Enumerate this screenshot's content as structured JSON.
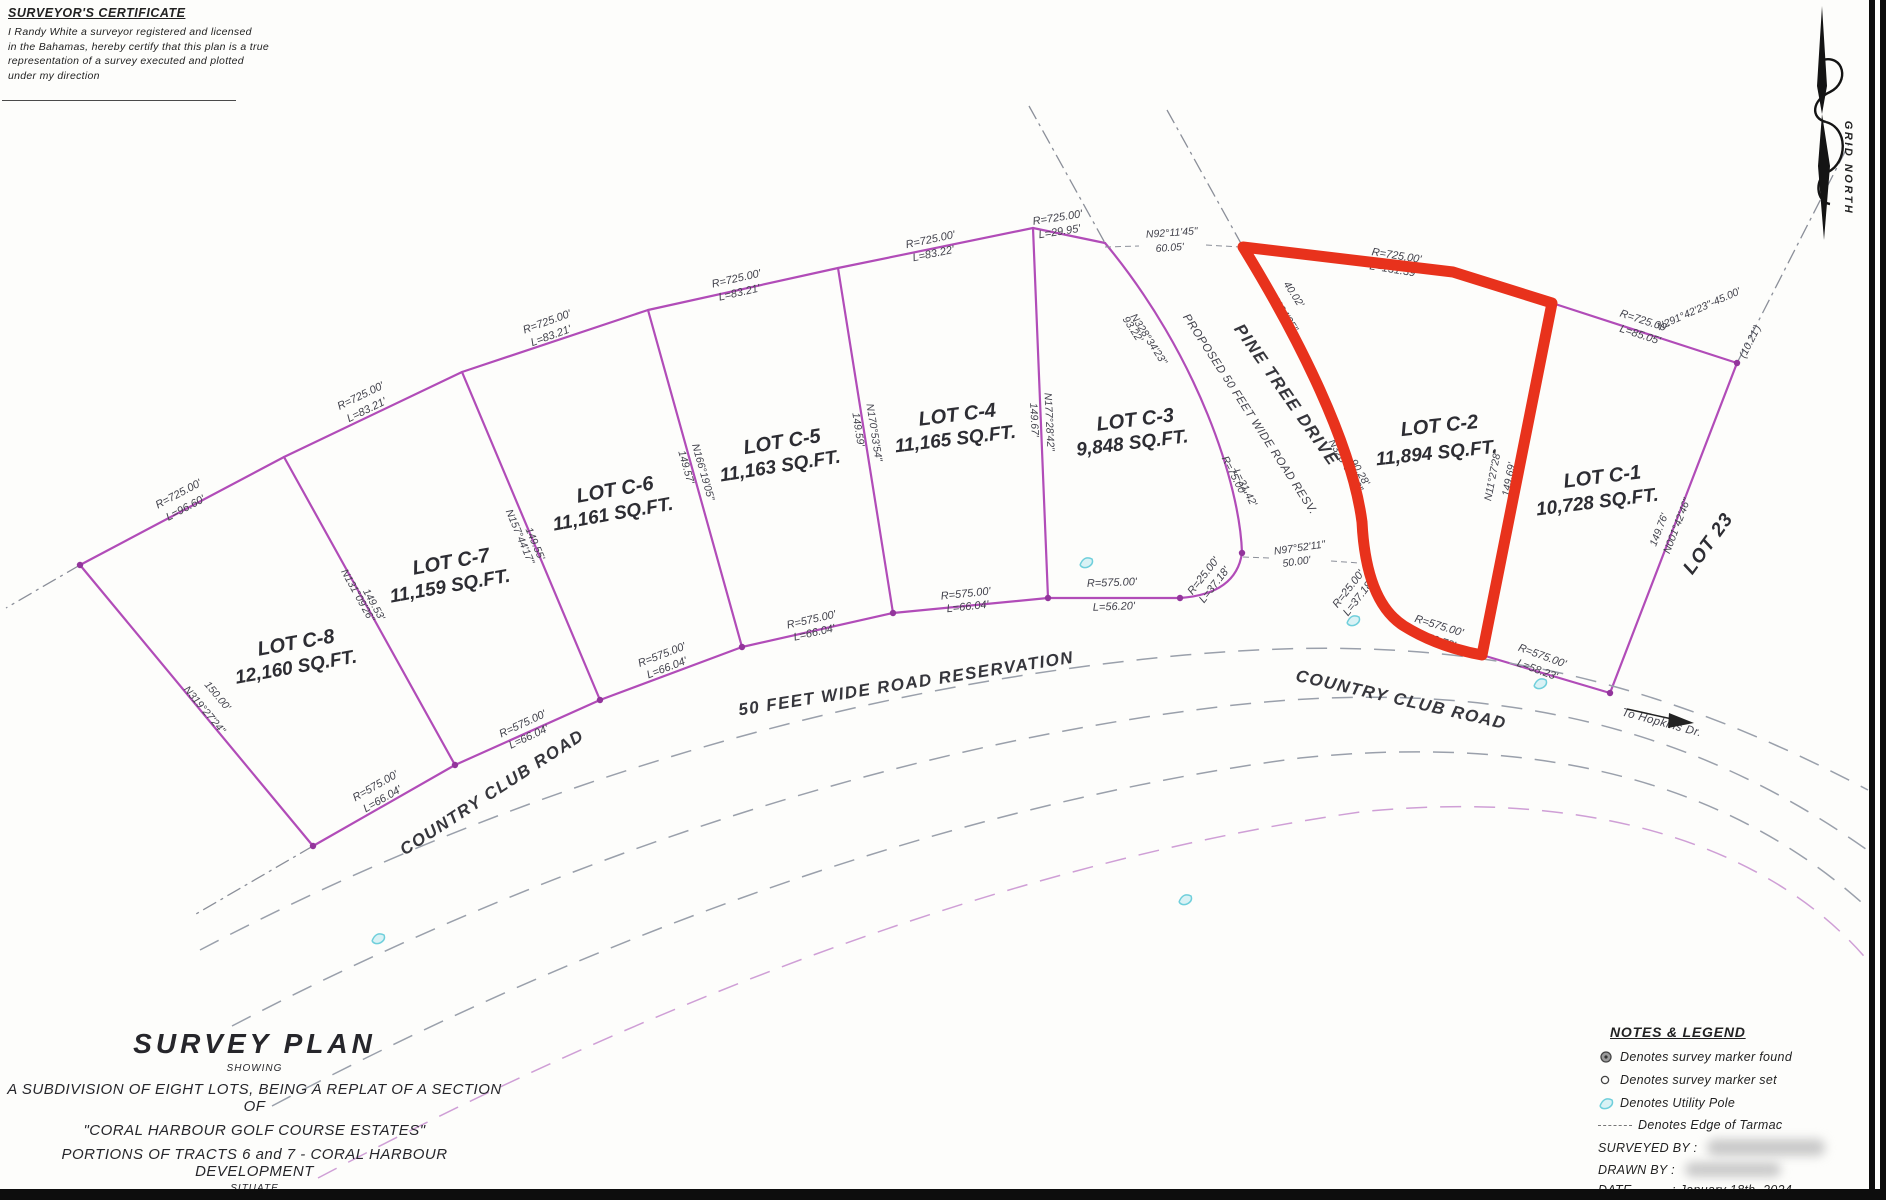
{
  "certificate": {
    "title": "SURVEYOR'S CERTIFICATE",
    "line1": "I Randy White a surveyor registered and licensed",
    "line2": "in the Bahamas, hereby certify that this plan is a true",
    "line3": "representation of a survey executed and plotted",
    "line4": "under my direction"
  },
  "north": {
    "label": "GRID NORTH"
  },
  "lots": [
    {
      "name": "LOT C-8",
      "area": "12,160 SQ.FT."
    },
    {
      "name": "LOT C-7",
      "area": "11,159 SQ.FT."
    },
    {
      "name": "LOT C-6",
      "area": "11,161 SQ.FT."
    },
    {
      "name": "LOT C-5",
      "area": "11,163 SQ.FT."
    },
    {
      "name": "LOT C-4",
      "area": "11,165 SQ.FT."
    },
    {
      "name": "LOT C-3",
      "area": "9,848 SQ.FT."
    },
    {
      "name": "LOT C-2",
      "area": "11,894 SQ.FT."
    },
    {
      "name": "LOT C-1",
      "area": "10,728 SQ.FT."
    }
  ],
  "roads": {
    "pine_tree": "PINE TREE DRIVE",
    "proposed": "PROPOSED 50 FEET WIDE ROAD RESV.",
    "reservation": "50 FEET WIDE ROAD RESERVATION",
    "country_club_left": "COUNTRY CLUB ROAD",
    "country_club_right": "COUNTRY CLUB ROAD",
    "to_hopkins": "To Hopkins Dr.",
    "lot_23": "LOT 23"
  },
  "dims": {
    "c8_top_r": "R=725.00'",
    "c8_top_l": "L=96.60'",
    "c7_top_r": "R=725.00'",
    "c7_top_l": "L=83.21'",
    "c6_top_r": "R=725.00'",
    "c6_top_l": "L=83.21'",
    "c5_top_r": "R=725.00'",
    "c5_top_l": "L=83.21'",
    "c4_top_r": "R=725.00'",
    "c4_top_l": "L=83.22'",
    "c3_top_r": "R=725.00'",
    "c3_top_l": "L=29.95'",
    "c2_top_r": "R=725.00'",
    "c2_top_l": "L=131.39'",
    "c1_top_r": "R=725.00'",
    "c1_top_l": "L=85.05'",
    "c8_bot_r": "R=575.00'",
    "c8_bot_l": "L=66.04'",
    "c7_bot_r": "R=575.00'",
    "c7_bot_l": "L=66.04'",
    "c6_bot_r": "R=575.00'",
    "c6_bot_l": "L=66.04'",
    "c5_bot_r": "R=575.00'",
    "c5_bot_l": "L=66.04'",
    "c4_bot_r": "R=575.00'",
    "c4_bot_l": "L=66.04'",
    "c3_bot_r": "R=575.00'",
    "c3_bot_l": "L=56.20'",
    "c3_curve_r": "R=25.00'",
    "c3_curve_l": "L=37.18'",
    "c2_curve_r": "R=25.00'",
    "c2_curve_l": "L=37.18'",
    "c2_bot_r": "R=575.00'",
    "c2_bot_l": "L=52.78'",
    "c1_bot_r": "R=575.00'",
    "c1_bot_l": "L=58.23'",
    "c8_sw_len": "150.00'",
    "c8_sw_brg": "N319°27'24\"",
    "d87_brg": "N131°09'26\"",
    "d87_len": "149.53'",
    "d76_brg": "N157°44'17\"",
    "d76_len": "149.55'",
    "d65_brg": "N166°19'05\"",
    "d65_len": "149.57'",
    "d54_brg": "N170°53'54\"",
    "d54_len": "149.59'",
    "d43_brg": "N177°28'42\"",
    "d43_len": "149.67'",
    "d21_brg": "N11°27'28\"",
    "d21_len": "149.69'",
    "c1_e_brg": "N001°42'46\"",
    "c1_e_len": "149.76'",
    "road_top_brg": "N92°11'45\"",
    "road_top_len": "60.05'",
    "road_bot_brg": "N97°52'11\"",
    "road_bot_len": "50.00'",
    "c3_e_len": "93.22'",
    "c3_e_brg": "N328°34'23\"",
    "c2_w_len1": "40.02'",
    "c2_w_brg1": "N328°34'25\"",
    "c2_w_brg2": "N328°34'23\"",
    "c2_w_len2": "90.28'",
    "c3_e_curve_r": "R=75.00'",
    "c3_e_curve_l": "L=31.42'",
    "ne_brg": "N291°42'23\"-45.00'",
    "ne_tick": "(10.21')"
  },
  "title_block": {
    "title": "SURVEY PLAN",
    "showing": "SHOWING",
    "line1": "A SUBDIVISION OF EIGHT LOTS, BEING A REPLAT OF A SECTION OF",
    "line2": "\"CORAL HARBOUR GOLF COURSE ESTATES\"",
    "line3": "PORTIONS OF TRACTS 6 and 7 - CORAL HARBOUR DEVELOPMENT",
    "situate": "SITUATE",
    "line4": "ON THE NORTHERN SIDE OF COUNTRY CLUB ROAD"
  },
  "legend": {
    "title": "NOTES & LEGEND",
    "items": [
      {
        "symbol": "survey-marker-found",
        "text": "Denotes survey marker found"
      },
      {
        "symbol": "survey-marker-set",
        "text": "Denotes survey marker set"
      },
      {
        "symbol": "utility-pole",
        "text": "Denotes Utility Pole"
      },
      {
        "symbol": "edge-of-tarmac",
        "text": "Denotes Edge of Tarmac"
      }
    ],
    "surveyed_by": "SURVEYED BY :",
    "drawn_by": "DRAWN BY :",
    "date_label": "DATE",
    "date_value": ": January 18th, 2024"
  },
  "colors": {
    "boundary": "#b14cb8",
    "highlight": "#e8321c",
    "tarmac_dash": "#9aa0ab",
    "utility": "#6fcfdb"
  }
}
